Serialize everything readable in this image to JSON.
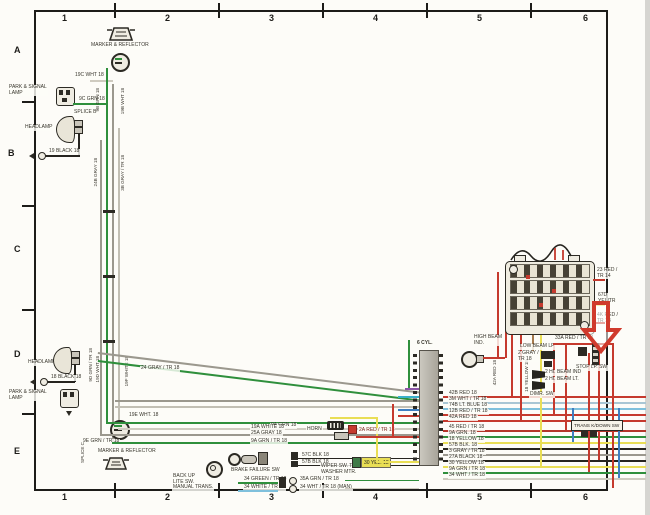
{
  "grid": {
    "cols": [
      "1",
      "2",
      "3",
      "4",
      "5",
      "6"
    ],
    "rows": [
      "A",
      "B",
      "C",
      "D",
      "E"
    ]
  },
  "components": {
    "marker_top": "MARKER & REFLECTOR",
    "park_top": "PARK & SIGNAL\nLAMP",
    "splice_b": "SPLICE B",
    "headlamp_top": "HEADLAMP",
    "headlamp_bot": "HEADLAMP",
    "park_bot": "PARK & SIGNAL\nLAMP",
    "splice_c": "SPLICE C",
    "marker_bot": "MARKER & REFLECTOR",
    "backup_sw": "BACK UP\nLITE SW.\nMANUAL TRANS.",
    "brake_failure_sw": "BRAKE FAILURE SW",
    "horn": "HORN",
    "wiper_sw": "WIPER SW. TO\nWASHER MTR.",
    "six_cyl": "6 CYL.",
    "high_beam_ind": "HIGH BEAM\nIND.",
    "low_beam": "LOW BEAM LP",
    "low_beam_wire": "2 GRAY /\nTR 18",
    "dimmer_sw": "DIMR. SW",
    "stop_lamp_sw": "STOP LP. SW",
    "hi_beam_ind_wire": "2 HI. BEAM IND",
    "hi_beam_lt_wire": "2 HI. BEAM LT.",
    "trans_kickdown_sw": "TRANS K/DOWN SW"
  },
  "wires": {
    "w19c": "19C WHT 18",
    "w9c": "9C GRN 18",
    "w19blk": "19 BLACK 18",
    "w9b": "9B GRN 18",
    "w19b": "19B WHT 18",
    "w24b": "24B GRAY 18",
    "w3b": "3B GRAY / TR 18",
    "w18blk": "18 BLACK 18",
    "w9d": "9D GRN / TR 18",
    "w19d": "19D WHT 18",
    "w19f": "19F WHITE 18",
    "w19e": "19E WHT. 18",
    "w9e": "9E GRN / TR 18",
    "w24gray": "24 GRAY / TR 18",
    "w9a": "9A GRN 18",
    "w19a": "19A WHITE 18",
    "w25a": "25A GRAY 18",
    "w9atr": "9A GRN / TR 18",
    "w34grn": "34 GREEN / TR 18",
    "w34wht": "34 WHITE / TR 18",
    "w57c": "57C BLK 18",
    "w57b": "57B BLK 18",
    "w35a": "35A GRN / TR 18",
    "w34man": "34 WHT / TR 18 (MAN)",
    "w30yel": "30 YEL. 18",
    "w2a": "2A RED / TR 18",
    "w42b": "42B RED 18",
    "w3m": "3M WHT / TR 18",
    "w74b": "74B LT. BLUE 18",
    "w12b": "12B RED / TR 18",
    "w42a": "42A RED 18",
    "w45": "45 RED / TR 18",
    "w9ar": "9A GRN. 18",
    "w18yel": "18 YELLOW 18",
    "w57br": "57B BLK. 18",
    "w3gray": "3 GRAY / TR 18",
    "w27a": "27A BLACK 18",
    "w30yelr": "30 YELLOW 18",
    "w9atrr": "9A GRN / TR 18",
    "w34whtr": "34 WHT / TR 18",
    "w23red": "23 RED /\nTR 14",
    "w67d": "67D\nYEL/TR",
    "w4k": "4K RED /\nTR 18",
    "w33a": "33A RED / TR 14",
    "w42av": "42A RED 18",
    "w18yelv": "18 YELLOW 18"
  },
  "colors": {
    "green": "#2f8f3c",
    "gray": "#9b988e",
    "red": "#c53a2e",
    "dark_red": "#b5352a",
    "yellow": "#e9de55",
    "blue": "#3f7fc1",
    "lt_blue": "#7fc0dc",
    "black": "#26241f",
    "brown": "#a5794d",
    "purple": "#8d56a8",
    "white_wire": "#cfcbc0",
    "arrow_red": "#d03a2c"
  }
}
